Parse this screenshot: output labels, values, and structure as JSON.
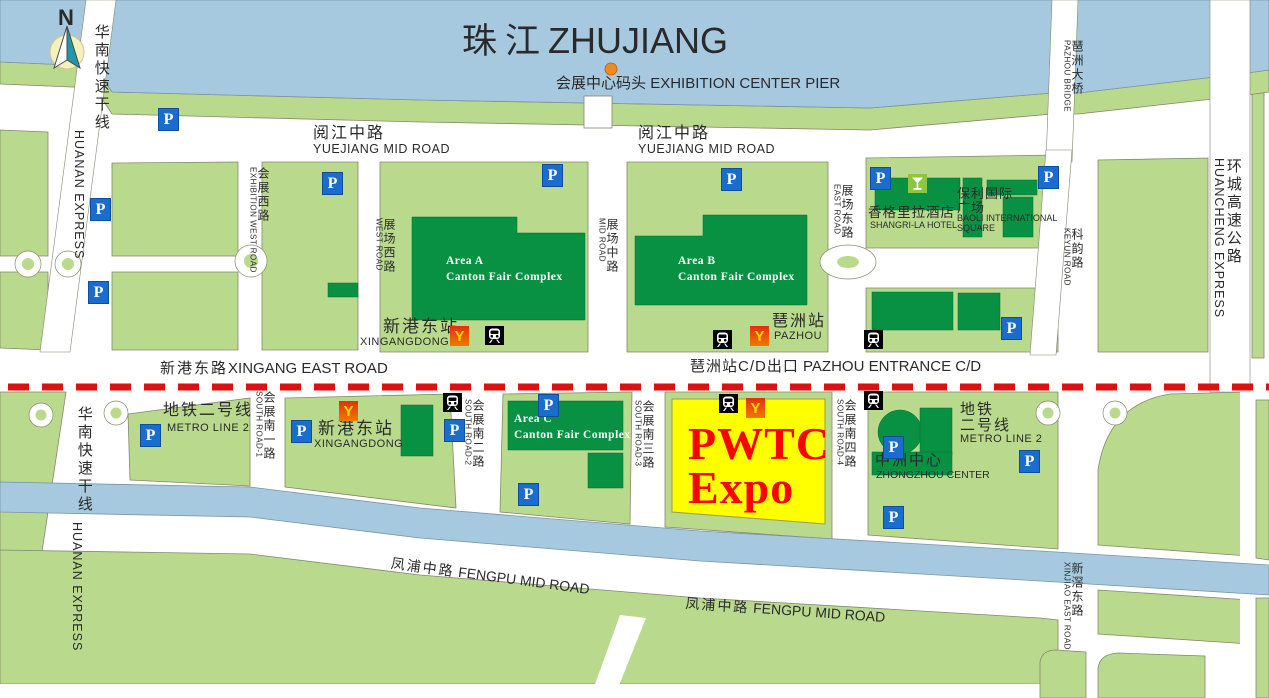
{
  "compass": {
    "label": "N"
  },
  "icons": {
    "parking": "P",
    "metro_logo": "Y"
  },
  "river": {
    "cn": "珠江",
    "en": "ZHUJIANG"
  },
  "pier": {
    "cn": "会展中心码头",
    "en": "EXHIBITION CENTER PIER"
  },
  "roads": {
    "yuejiang": {
      "cn": "阅江中路",
      "en": "YUEJIANG MID ROAD"
    },
    "huanan": {
      "cn": "华南快速干线",
      "en": "HUANAN EXPRESS"
    },
    "exhibition_west": {
      "cn": "会展西路",
      "en": "EXHIBITION WEST ROAD"
    },
    "west": {
      "cn": "展场西路",
      "en": "WEST ROAD"
    },
    "mid": {
      "cn": "展场中路",
      "en": "MID ROAD"
    },
    "east": {
      "cn": "展场东路",
      "en": "EAST ROAD"
    },
    "keyun": {
      "cn": "科韵路",
      "en": "KEYUN ROAD"
    },
    "huancheng": {
      "cn": "环城高速公路",
      "en": "HUANCHENG EXPRESS"
    },
    "pazhou_bridge": {
      "cn": "琶洲大桥",
      "en": "PAZHOU BRIDGE"
    },
    "xingang_east": {
      "cn": "新港东路",
      "en": "XINGANG EAST ROAD"
    },
    "south1": {
      "cn": "会展南一路",
      "en": "SOUTH ROAD-1"
    },
    "south2": {
      "cn": "会展南二路",
      "en": "SOUTH ROAD-2"
    },
    "south3": {
      "cn": "会展南三路",
      "en": "SOUTH ROAD-3"
    },
    "south4": {
      "cn": "会展南四路",
      "en": "SOUTH ROAD-4"
    },
    "fengpu": {
      "cn": "凤浦中路",
      "en": "FENGPU MID ROAD"
    },
    "xinjiao": {
      "cn": "新滘东路",
      "en": "XINJIAO EAST ROAD"
    },
    "metro2": {
      "cn": "地铁二号线",
      "cn_l1": "地铁",
      "cn_l2": "二号线",
      "en": "METRO LINE 2"
    }
  },
  "stations": {
    "xingangdong": {
      "cn": "新港东站",
      "en": "XINGANGDONG"
    },
    "pazhou": {
      "cn": "琶洲站",
      "en": "PAZHOU"
    },
    "entrance": {
      "cn": "琶洲站C/D出口",
      "en": "PAZHOU ENTRANCE C/D"
    }
  },
  "places": {
    "area_a": {
      "l1": "Area  A",
      "l2": "Canton Fair Complex"
    },
    "area_b": {
      "l1": "Area  B",
      "l2": "Canton Fair Complex"
    },
    "area_c": {
      "l1": "Area  C",
      "l2": "Canton Fair Complex"
    },
    "pwtc": {
      "l1": "PWTC",
      "l2": "Expo"
    },
    "shangrila": {
      "cn": "香格里拉酒店",
      "en": "SHANGRI-LA HOTEL"
    },
    "baoli": {
      "cn1": "保利国际",
      "cn2": "广场",
      "en1": "BAOLI INTERNATIONAL",
      "en2": "SQUARE"
    },
    "zhongzhou": {
      "cn": "中洲中心",
      "en": "ZHONGZHOU CENTER"
    }
  },
  "colors": {
    "water": "#a6c9e0",
    "land": "#b9da8c",
    "building": "#089143",
    "parking_blue": "#1a6dcc",
    "highlight_fill": "#ffff00",
    "highlight_text": "#ff0000",
    "boundary_dash": "#dd1111",
    "metro_red": "#e8380d",
    "metro_yellow": "#ffd900",
    "pier_dot": "#f08a1d",
    "hotel_green": "#8cc63e"
  }
}
